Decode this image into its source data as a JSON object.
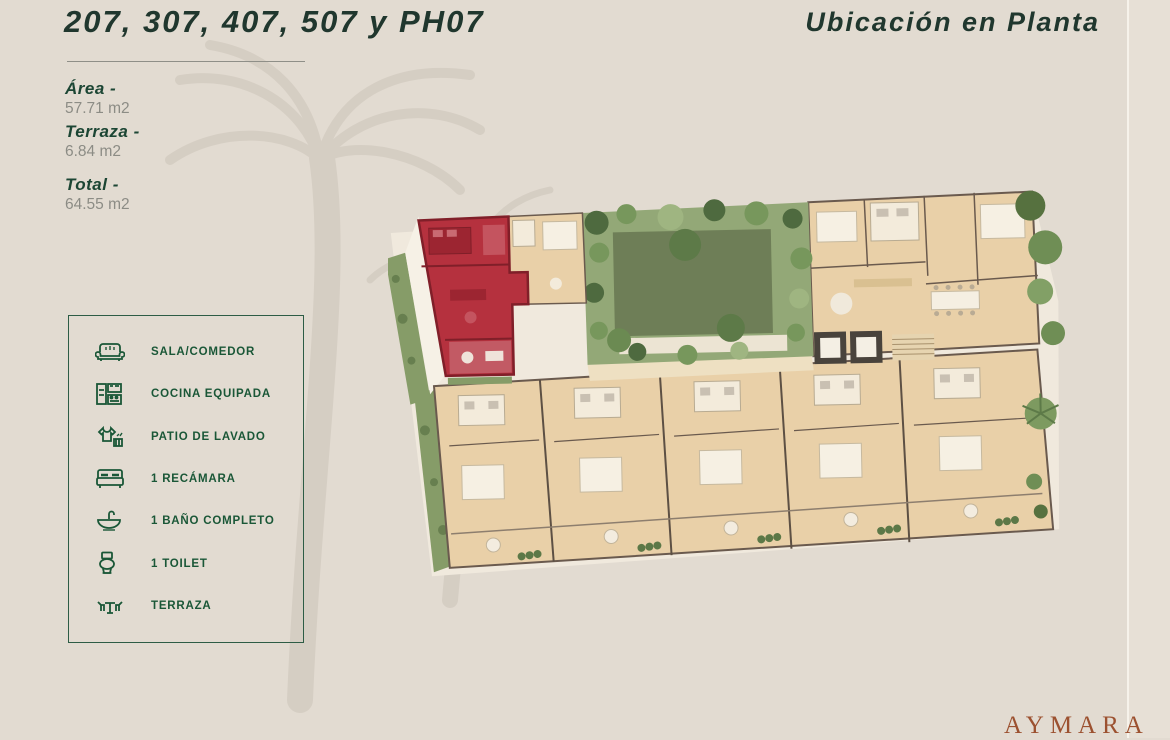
{
  "page": {
    "background": "#e2dbd1",
    "divider_color": "#f6f2ea"
  },
  "header": {
    "title": "207, 307, 407, 507 y PH07",
    "subtitle": "Ubicación en Planta",
    "text_color": "#20372e"
  },
  "stats": {
    "items": [
      {
        "label": "Área -",
        "value": "57.71 m2"
      },
      {
        "label": "Terraza -",
        "value": "6.84 m2"
      },
      {
        "label": "Total -",
        "value": "64.55 m2"
      }
    ]
  },
  "legend": {
    "border_color": "#2d5c45",
    "accent_color": "#1a5737",
    "items": [
      {
        "icon": "sofa-icon",
        "label": "SALA/COMEDOR"
      },
      {
        "icon": "kitchen-icon",
        "label": "COCINA EQUIPADA"
      },
      {
        "icon": "laundry-icon",
        "label": "PATIO DE LAVADO"
      },
      {
        "icon": "bed-icon",
        "label": "1 RECÁMARA"
      },
      {
        "icon": "sink-icon",
        "label": "1 BAÑO COMPLETO"
      },
      {
        "icon": "toilet-icon",
        "label": "1 TOILET"
      },
      {
        "icon": "terrace-icon",
        "label": "TERRAZA"
      }
    ]
  },
  "floorplan": {
    "highlight_color": "#b5313e",
    "highlighted_unit_position": "top-left"
  },
  "brand": {
    "name": "AYMARA",
    "color": "#9c5130"
  }
}
